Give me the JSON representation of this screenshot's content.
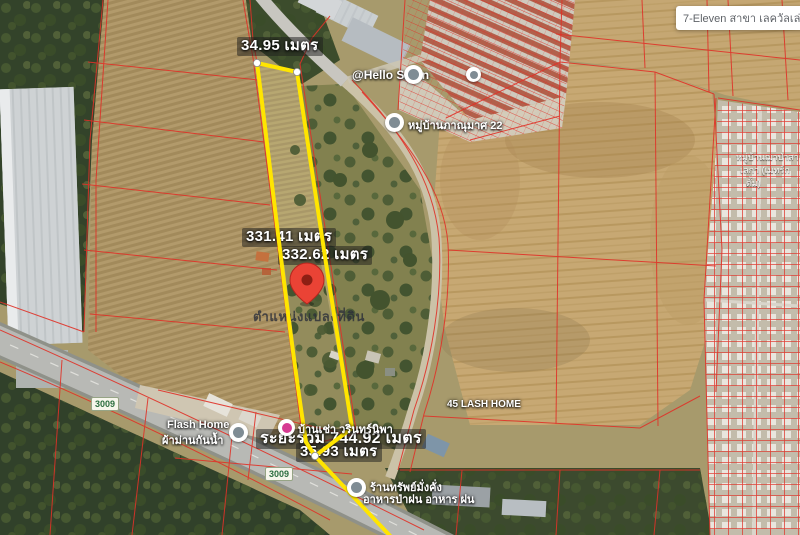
{
  "window": {
    "tooltip": "7-Eleven สาขา เลควัลเล่ย์ (บุ"
  },
  "measurements": {
    "top_edge": "34.95 เมตร",
    "left_edge": "331.41 เมตร",
    "right_edge": "332.62 เมตร",
    "total": "ระยะรวม 744.92 เมตร",
    "bottom_edge": "35.93 เมตร",
    "plot_caption": "ตำแหน่งแปลงที่ดิน"
  },
  "poi": {
    "hello_salon": "@Hello Salon",
    "village": "หมู่บ้านภาณุมาศ 22",
    "flash_home_1": "Flash Home",
    "flash_home_2": "ผ้าม่านกันน้ำ",
    "house_rent": "บ้านเช่า วรินทร์นิพา",
    "lash_home": "45 LASH HOME",
    "restaurant_1": "ร้านทรัพย์มั่งคั่ง",
    "restaurant_2": "อาหารป่าฝน อาหาร ฝน",
    "right_area_1": "หมู่บ้านฌาป่าสา",
    "right_area_2": "เลกา (เมทร์ก",
    "right_area_3": "ตั้ม)"
  },
  "roads": {
    "shield_1": "3009",
    "shield_2": "3009"
  },
  "colors": {
    "plot_outline": "#ffe500",
    "parcel_lines": "#e03228",
    "pin": "#ea4335"
  }
}
